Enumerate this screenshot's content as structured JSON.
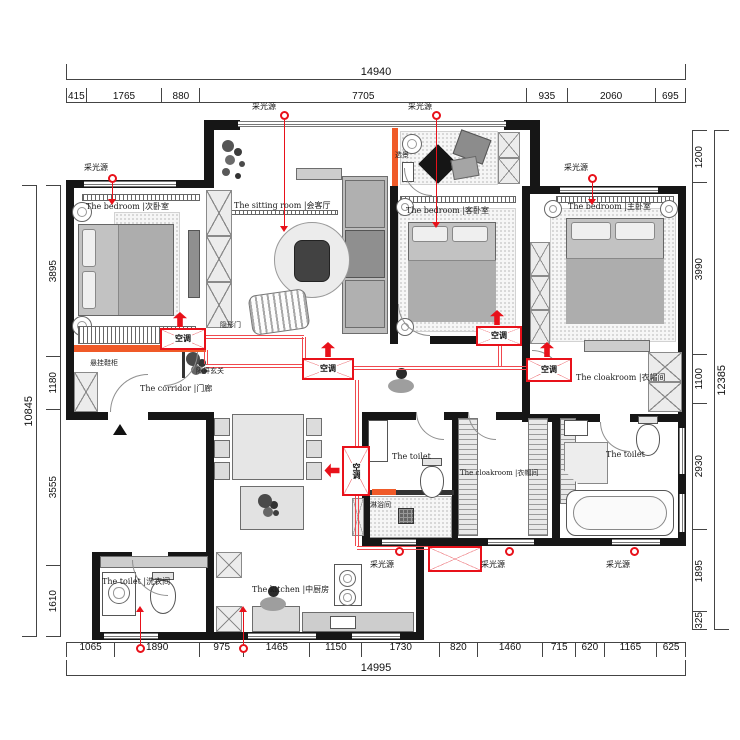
{
  "dimensions": {
    "top": {
      "total": "14940",
      "segments": [
        "415",
        "1765",
        "880",
        "7705",
        "935",
        "2060",
        "695"
      ]
    },
    "bottom": {
      "total": "14995",
      "segments": [
        "1065",
        "1890",
        "975",
        "1465",
        "1150",
        "1730",
        "820",
        "1460",
        "715",
        "620",
        "1165",
        "625"
      ]
    },
    "left": {
      "total": "10845",
      "segments": [
        "3895",
        "1180",
        "3555",
        "1610"
      ]
    },
    "right": {
      "total": "12385",
      "segments": [
        "1200",
        "3990",
        "1100",
        "2930",
        "1895",
        "325"
      ]
    }
  },
  "rooms": {
    "bedroom_left": "The bedroom |次卧室",
    "sitting_room": "The sitting room |会客厅",
    "bedroom_mid": "The bedroom |客卧室",
    "bedroom_right": "The bedroom |主卧室",
    "corridor": "The corridor |门廊",
    "cloakroom_center": "The cloakroom |衣帽间",
    "cloakroom_right": "The cloakroom |衣帽间",
    "toilet_center": "The toilet",
    "toilet_right": "The toilet",
    "laundry": "The toilet |洗衣间",
    "kitchen": "The kitchen |中厨房",
    "shower": "淋浴间"
  },
  "annotations": {
    "light_source": "采光源",
    "ac": "空调",
    "hidden_door": "隐形门",
    "screen_entry": "隔屏玄关",
    "shoe_cabinet": "悬挂鞋柜",
    "scenery": "选景"
  },
  "colors": {
    "wall": "#161616",
    "red": "#e8111a",
    "orange": "#f05a28"
  }
}
